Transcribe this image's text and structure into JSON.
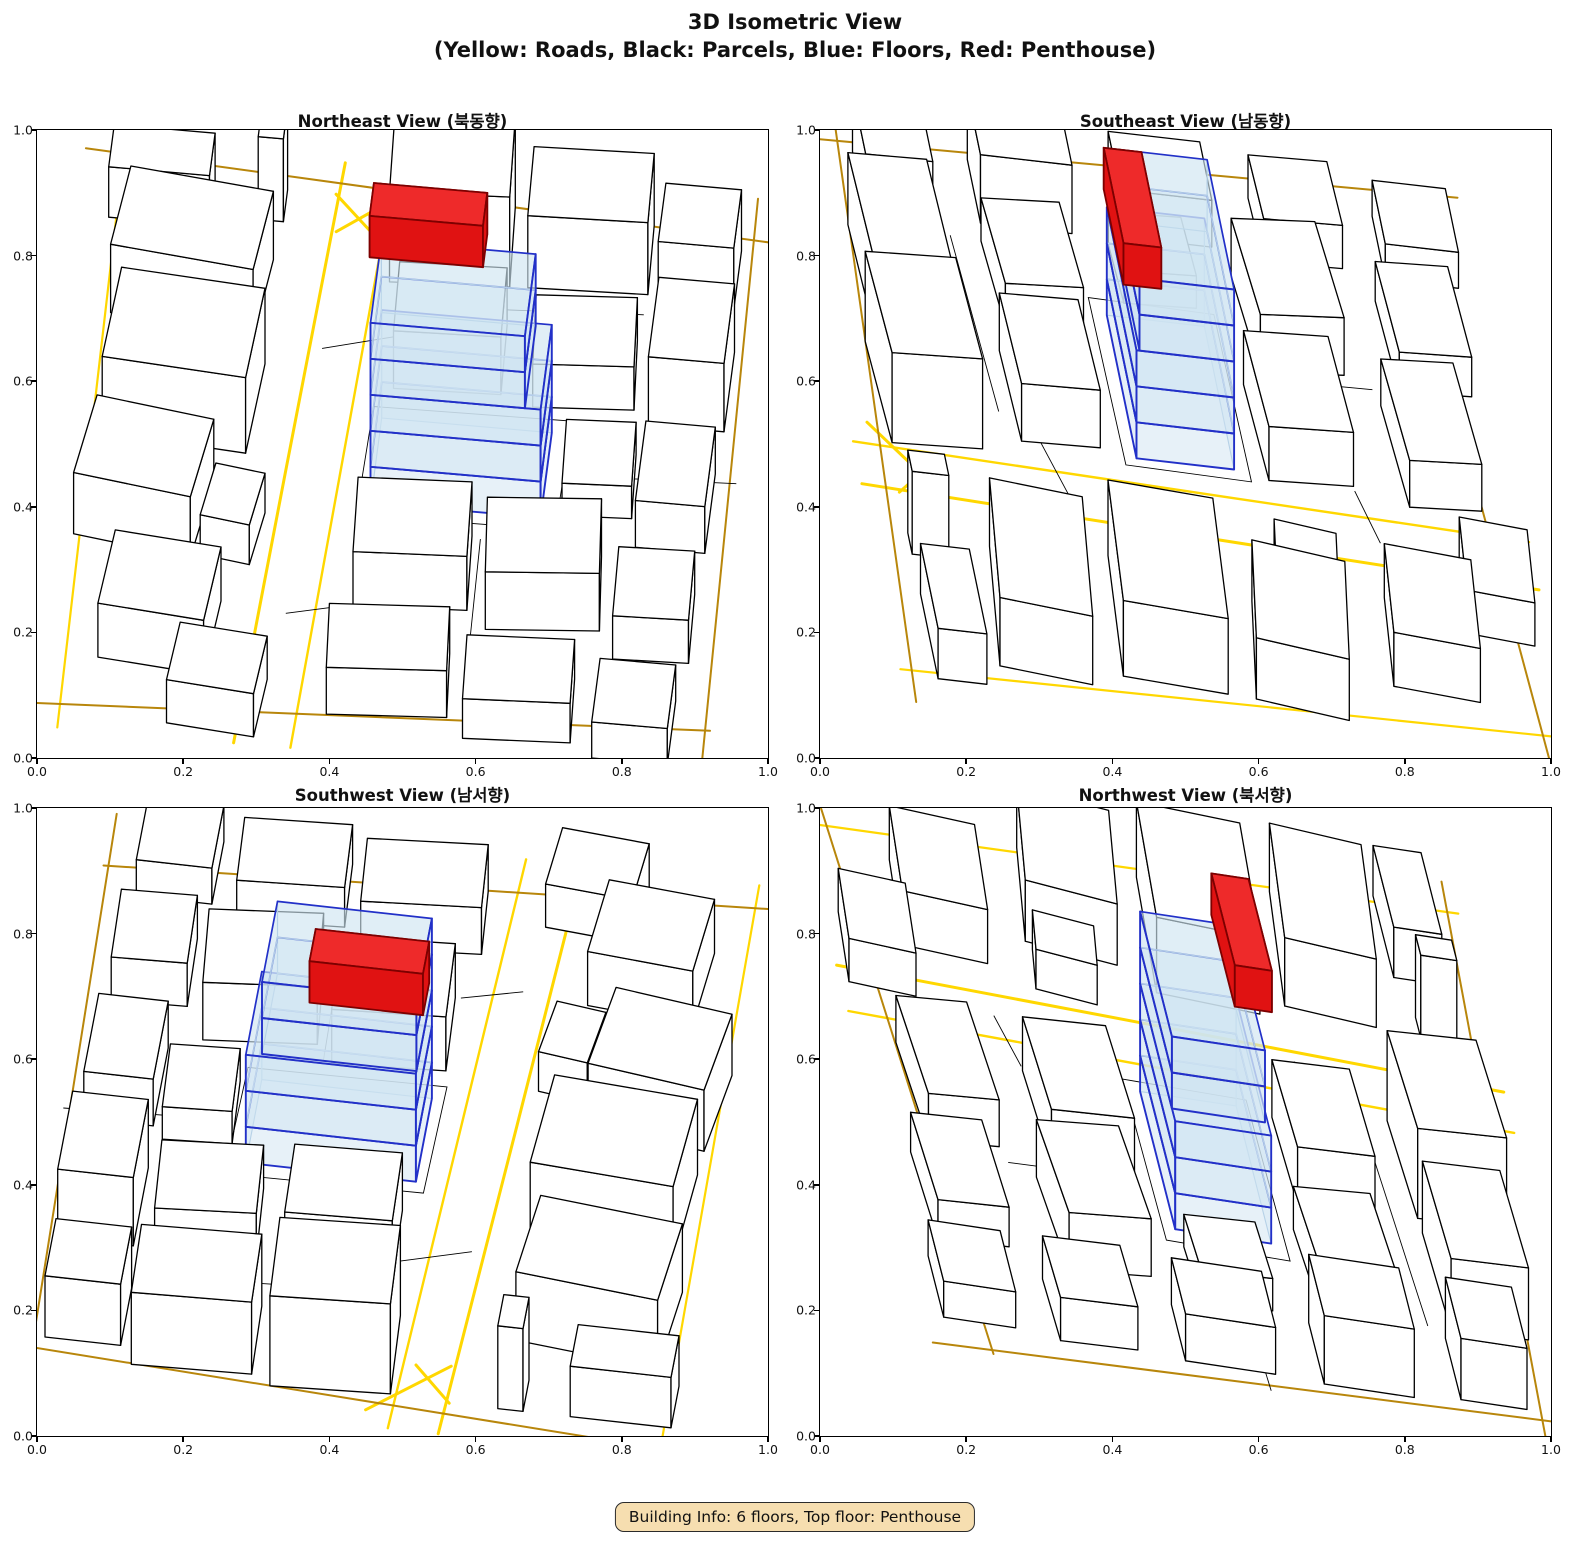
{
  "figure": {
    "title_line1": "3D Isometric View",
    "title_line2": "(Yellow: Roads, Black: Parcels, Blue: Floors, Red: Penthouse)"
  },
  "badge": {
    "text": "Building Info: 6 floors, Top floor: Penthouse"
  },
  "axis": {
    "ticks": [
      "0.0",
      "0.2",
      "0.4",
      "0.6",
      "0.8",
      "1.0"
    ],
    "range": [
      0.0,
      1.0
    ]
  },
  "panels": [
    {
      "id": "northeast",
      "title": "Northeast View (북동향)"
    },
    {
      "id": "southeast",
      "title": "Southeast View (남동향)"
    },
    {
      "id": "southwest",
      "title": "Southwest View (남서향)"
    },
    {
      "id": "northwest",
      "title": "Northwest View (북서향)"
    }
  ],
  "colors": {
    "road_bright": "#FFD700",
    "road_dark": "#B8860B",
    "parcel_stroke": "#000000",
    "building_fill": "#FFFFFF",
    "floor_fill": "#CFE4F1",
    "floor_edge": "#2230C8",
    "floor_edge_faint": "#9DBEDC",
    "penthouse_fill": "#E01212",
    "penthouse_top": "#EE2A2A",
    "penthouse_side": "#BC0E0E",
    "penthouse_edge": "#7D0000",
    "badge_bg": "#F6DEB0"
  },
  "chart_data": {
    "type": "3d-isometric-multiview",
    "axis_range": [
      0.0,
      1.0
    ],
    "views": [
      "Northeast View (북동향)",
      "Southeast View (남동향)",
      "Southwest View (남서향)",
      "Northwest View (북서향)"
    ],
    "legend": {
      "yellow": "Roads",
      "black": "Parcels",
      "blue": "Floors",
      "red": "Penthouse"
    },
    "building_info": {
      "floors": 6,
      "top_floor": "Penthouse",
      "blue_floor_count": 5
    },
    "scene": {
      "buildings": [
        [
          0.3,
          7.2,
          2.3,
          1.5,
          1.9,
          -6
        ],
        [
          0.4,
          5.0,
          2.3,
          1.7,
          2.1,
          -4
        ],
        [
          0.2,
          3.0,
          1.9,
          1.5,
          1.7,
          -8
        ],
        [
          2.2,
          2.9,
          0.8,
          1.0,
          1.1,
          -8
        ],
        [
          0.8,
          0.8,
          1.7,
          1.4,
          1.5,
          -5
        ],
        [
          0.0,
          9.1,
          1.6,
          0.8,
          1.4,
          0
        ],
        [
          2.35,
          9.3,
          0.4,
          0.6,
          2.3,
          0
        ],
        [
          2.0,
          -0.3,
          1.4,
          1.1,
          1.2,
          -5
        ],
        [
          4.5,
          8.4,
          1.9,
          1.5,
          2.5,
          3
        ],
        [
          6.7,
          8.5,
          1.9,
          1.3,
          2.0,
          2
        ],
        [
          8.8,
          8.4,
          1.2,
          1.1,
          1.7,
          0
        ],
        [
          4.8,
          6.4,
          1.7,
          1.3,
          1.6,
          2
        ],
        [
          7.0,
          6.3,
          1.6,
          1.3,
          1.2,
          4
        ],
        [
          8.9,
          6.1,
          1.2,
          1.5,
          1.9,
          0
        ],
        [
          7.7,
          4.3,
          1.1,
          1.2,
          0.9,
          3
        ],
        [
          8.95,
          3.8,
          1.1,
          1.5,
          1.3,
          0
        ],
        [
          4.6,
          2.3,
          1.8,
          1.4,
          1.5,
          3
        ],
        [
          6.7,
          2.1,
          1.8,
          1.4,
          1.6,
          5
        ],
        [
          8.8,
          1.7,
          1.2,
          1.3,
          1.2,
          2
        ],
        [
          4.4,
          0.25,
          1.9,
          1.2,
          1.3,
          4
        ],
        [
          6.6,
          0.0,
          1.7,
          1.2,
          1.1,
          3
        ],
        [
          8.7,
          -0.2,
          1.2,
          1.2,
          1.0,
          0
        ]
      ],
      "roads": [
        {
          "pts": [
            [
              3.05,
              -0.5
            ],
            [
              3.3,
              4.6
            ],
            [
              3.6,
              10.5
            ]
          ],
          "tone": "bright",
          "w": 3.0
        },
        {
          "pts": [
            [
              3.95,
              -0.5
            ],
            [
              4.15,
              4.4
            ],
            [
              4.4,
              10.5
            ]
          ],
          "tone": "bright",
          "w": 2.4
        },
        {
          "pts": [
            [
              3.6,
              9.2
            ],
            [
              4.8,
              10.2
            ]
          ],
          "tone": "bright",
          "w": 3.0
        },
        {
          "pts": [
            [
              3.52,
              9.9
            ],
            [
              4.15,
              9.25
            ]
          ],
          "tone": "bright",
          "w": 3.0
        },
        {
          "pts": [
            [
              0.25,
              -0.5
            ],
            [
              0.1,
              10.5
            ]
          ],
          "tone": "bright",
          "w": 2.2
        },
        {
          "pts": [
            [
              -0.5,
              10.35
            ],
            [
              10.5,
              9.7
            ]
          ],
          "tone": "dark",
          "w": 2.0
        },
        {
          "pts": [
            [
              -0.5,
              -0.1
            ],
            [
              10.5,
              0.5
            ]
          ],
          "tone": "dark",
          "w": 2.0
        },
        {
          "pts": [
            [
              10.45,
              -0.5
            ],
            [
              10.15,
              10.5
            ]
          ],
          "tone": "dark",
          "w": 2.0
        }
      ],
      "ground_lines": [
        {
          "pts": [
            [
              4.5,
              3.95
            ],
            [
              7.65,
              4.0
            ],
            [
              7.7,
              6.05
            ],
            [
              4.55,
              6.0
            ]
          ],
          "closed": true
        },
        {
          "pts": [
            [
              3.62,
              7.0
            ],
            [
              4.78,
              7.35
            ]
          ],
          "closed": false
        },
        {
          "pts": [
            [
              3.6,
              2.0
            ],
            [
              4.55,
              2.25
            ]
          ],
          "closed": false
        },
        {
          "pts": [
            [
              8.3,
              5.05
            ],
            [
              10.4,
              5.15
            ]
          ],
          "closed": false
        },
        {
          "pts": [
            [
              5.3,
              7.95
            ],
            [
              8.6,
              8.15
            ]
          ],
          "closed": false
        },
        {
          "pts": [
            [
              6.55,
              1.6
            ],
            [
              6.5,
              3.7
            ]
          ],
          "closed": false
        }
      ],
      "subject": {
        "x": 4.7,
        "y": 4.2,
        "w": 2.7,
        "d": 1.6,
        "floor_height": 1.0,
        "floors": [
          {
            "w": 2.7,
            "d": 1.6
          },
          {
            "w": 2.7,
            "d": 1.6
          },
          {
            "w": 2.7,
            "d": 1.6
          },
          {
            "w": 2.45,
            "d": 1.55
          },
          {
            "w": 2.45,
            "d": 1.55
          }
        ],
        "penthouse": {
          "x": 4.55,
          "y": 5.42,
          "w": 1.8,
          "d": 0.62,
          "h": 1.15
        }
      }
    }
  }
}
